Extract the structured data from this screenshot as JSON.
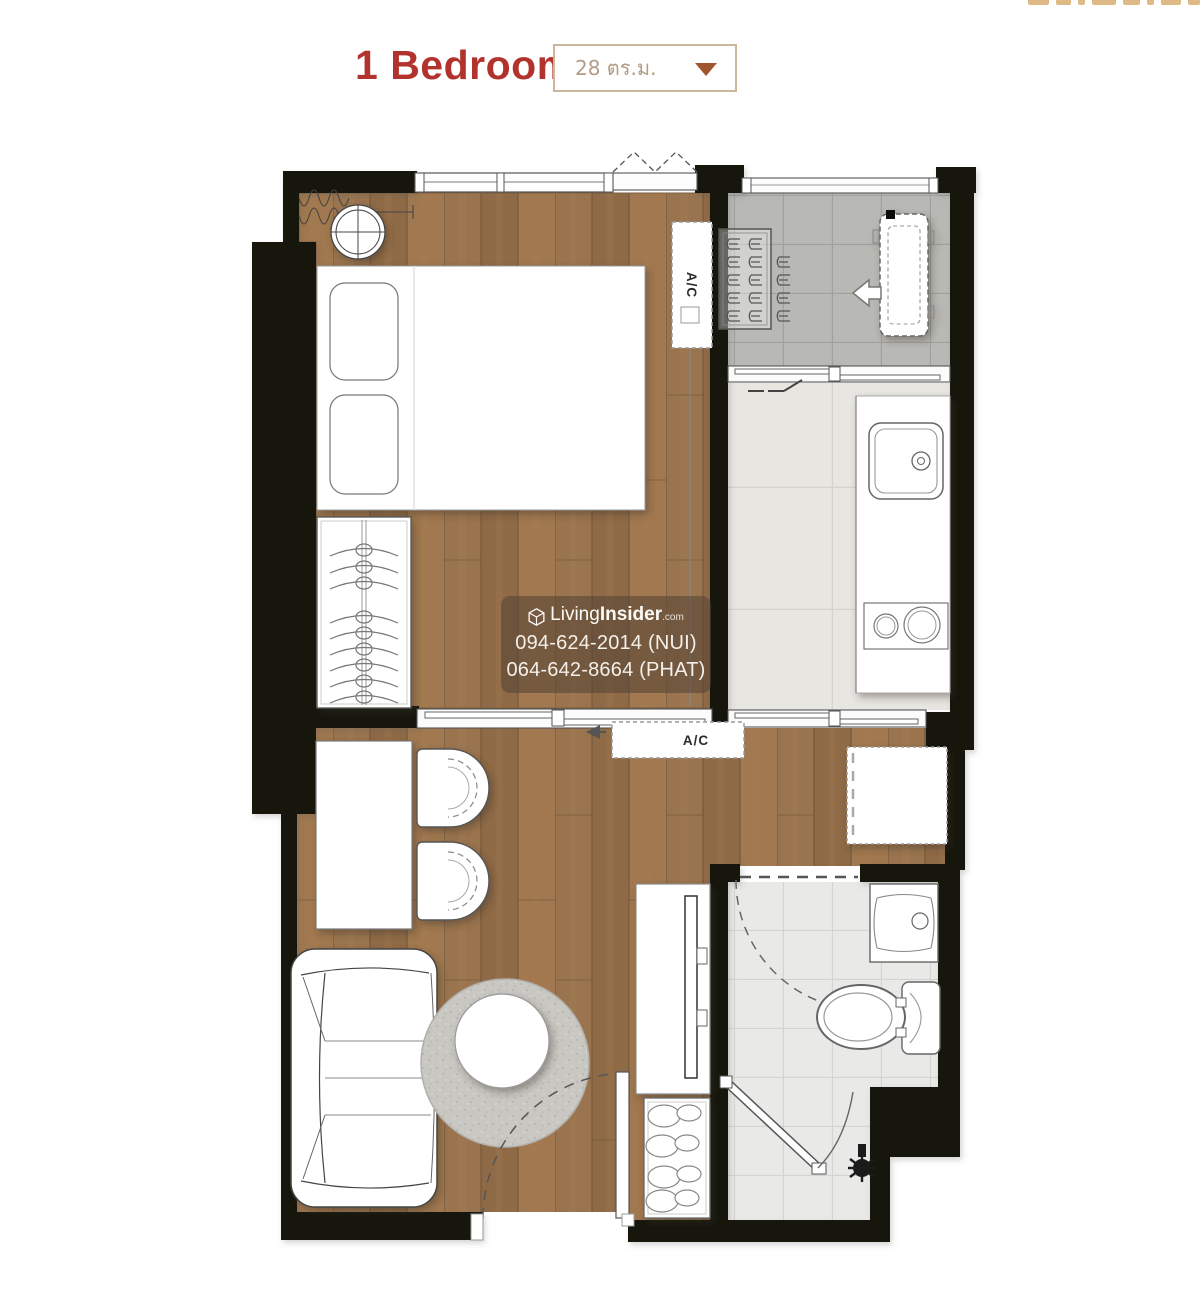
{
  "header": {
    "title": "1 Bedroom",
    "size_dropdown": {
      "value": "28 ตร.ม."
    }
  },
  "floor_plan": {
    "bedroom_ac_label": "A/C",
    "living_ac_label": "A/C"
  },
  "watermark": {
    "brand_prefix": "Living",
    "brand_suffix": "Insider",
    "brand_domain": ".com",
    "phone_line1": "094-624-2014 (NUI)",
    "phone_line2": "064-642-8664 (PHAT)"
  },
  "colors": {
    "title_red": "#b2332e",
    "dropdown_border": "#cdb79c",
    "dropdown_text": "#b39b85",
    "dropdown_arrow": "#a1562d",
    "wall_black": "#17120e",
    "wood_floor": "#97714c",
    "entry_tile_gray": "#b8b8b4",
    "kitchen_tile_cream": "#e8e6e1",
    "bath_tile": "#e9e9e7",
    "rug_gray": "#c9c7c2"
  }
}
